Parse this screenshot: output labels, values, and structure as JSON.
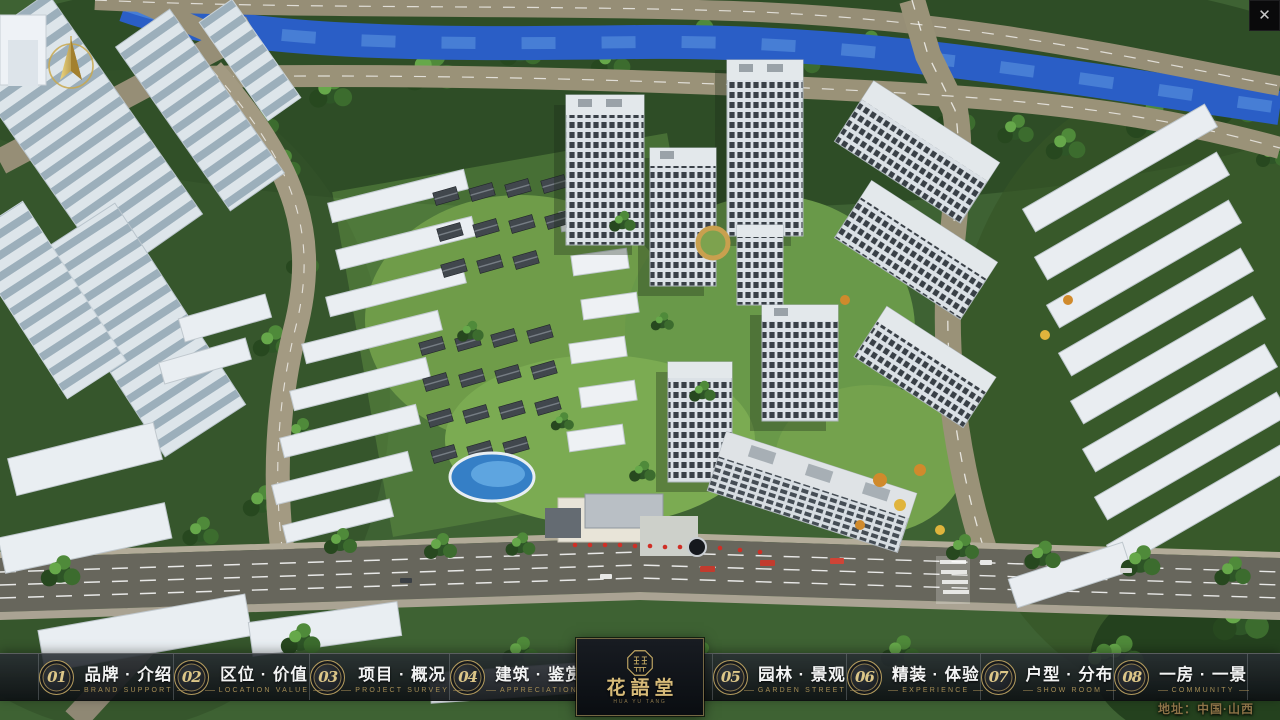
{
  "scene": {
    "description": "aerial-3d-masterplan-render"
  },
  "close_button": {
    "glyph": "✕"
  },
  "address": "地址：中国·山西",
  "logo": {
    "title": "花語堂",
    "subtitle": "HUA YU TANG"
  },
  "nav": {
    "items": [
      {
        "num": "01",
        "zh": "品牌 · 介绍",
        "en": "BRAND SUPPORT"
      },
      {
        "num": "02",
        "zh": "区位 · 价值",
        "en": "LOCATION VALUE"
      },
      {
        "num": "03",
        "zh": "项目 · 概况",
        "en": "PROJECT SURVEY"
      },
      {
        "num": "04",
        "zh": "建筑 · 鉴赏",
        "en": "APPRECIATION"
      },
      {
        "num": "05",
        "zh": "园林 · 景观",
        "en": "GARDEN STREET"
      },
      {
        "num": "06",
        "zh": "精装 · 体验",
        "en": "EXPERIENCE"
      },
      {
        "num": "07",
        "zh": "户型 · 分布",
        "en": "SHOW ROOM"
      },
      {
        "num": "08",
        "zh": "一房 · 一景",
        "en": "COMMUNITY"
      }
    ]
  },
  "colors": {
    "accent_gold": "#b49c5e",
    "bar_background": "#14181d",
    "logo_text": "#d6ba78",
    "river_blue": "#2a5ec6",
    "address_text": "#8c7347"
  }
}
